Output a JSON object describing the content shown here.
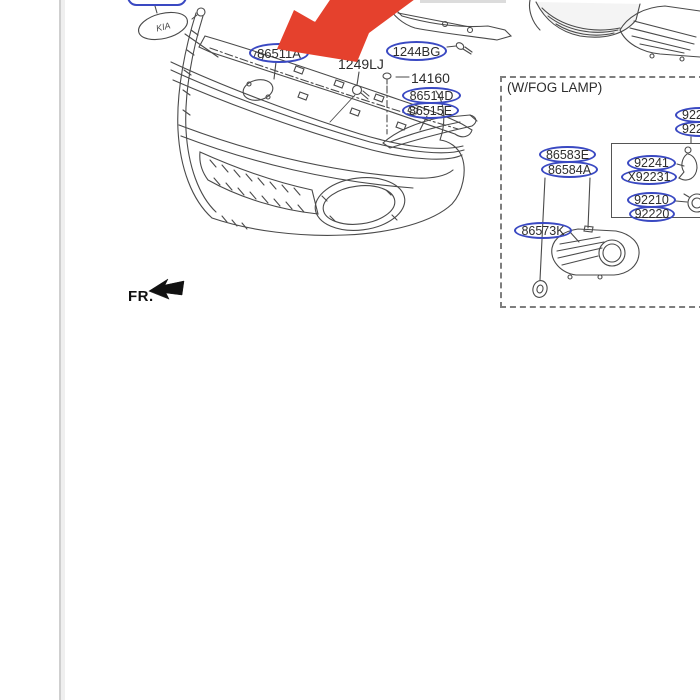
{
  "image_alt": "Kia front bumper and radiator grille parts diagram, red arrow annotation pointing at grille part 86511A",
  "colors": {
    "label_outline_blue": "#3a49c2",
    "annotation_arrow_red": "#e5412d",
    "line_art_gray": "#4a4a4a",
    "page_divider_gray": "#cfcfcf",
    "text": "#2d2d2d"
  },
  "emblem_text": "KIA",
  "parts": {
    "grille": "86511A",
    "bolt_grille": "1249LJ",
    "support_rail": "1244BG",
    "screw_clip": "14160",
    "side_bracket_upper": "86514D",
    "side_bracket_lower": "86515E"
  },
  "fog_section": {
    "title": "(W/FOG LAMP)",
    "lamp_upper": "9220",
    "lamp_lower": "9220",
    "mount_bracket_upper": "92241",
    "mount_bracket_lower": "X92231",
    "bulb_upper": "92210",
    "bulb_lower": "92220",
    "cover_upper": "86583E",
    "cover_lower": "86584A",
    "bezel": "86573K"
  },
  "orientation": {
    "front_label": "FR."
  }
}
